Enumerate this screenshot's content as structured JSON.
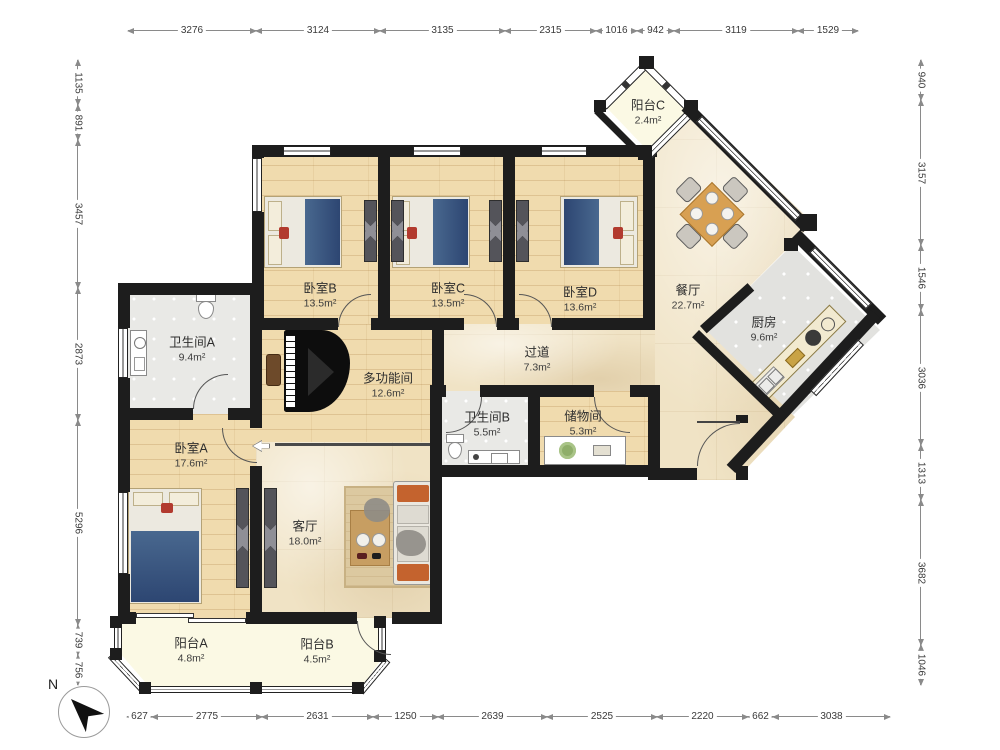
{
  "title": "apartment-floor-plan",
  "compass": {
    "north_label": "N"
  },
  "rooms": {
    "bedroomB": {
      "name": "卧室B",
      "area": "13.5m²"
    },
    "bedroomC": {
      "name": "卧室C",
      "area": "13.5m²"
    },
    "bedroomD": {
      "name": "卧室D",
      "area": "13.6m²"
    },
    "balconyC": {
      "name": "阳台C",
      "area": "2.4m²"
    },
    "dining": {
      "name": "餐厅",
      "area": "22.7m²"
    },
    "kitchen": {
      "name": "厨房",
      "area": "9.6m²"
    },
    "bathroomA": {
      "name": "卫生间A",
      "area": "9.4m²"
    },
    "multiroom": {
      "name": "多功能间",
      "area": "12.6m²"
    },
    "hallway": {
      "name": "过道",
      "area": "7.3m²"
    },
    "bathroomB": {
      "name": "卫生间B",
      "area": "5.5m²"
    },
    "storage": {
      "name": "储物间",
      "area": "5.3m²"
    },
    "bedroomA": {
      "name": "卧室A",
      "area": "17.6m²"
    },
    "living": {
      "name": "客厅",
      "area": "18.0m²"
    },
    "balconyA": {
      "name": "阳台A",
      "area": "4.8m²"
    },
    "balconyB": {
      "name": "阳台B",
      "area": "4.5m²"
    }
  },
  "dimensions": {
    "top": [
      "3276",
      "3124",
      "3135",
      "2315",
      "1016",
      "942",
      "3119",
      "1529"
    ],
    "bottom": [
      "627",
      "2775",
      "2631",
      "1250",
      "2639",
      "2525",
      "2220",
      "662",
      "3038"
    ],
    "left": [
      "1135",
      "891",
      "3457",
      "2873",
      "5296",
      "739",
      "756"
    ],
    "right": [
      "940",
      "3157",
      "1546",
      "3036",
      "1313",
      "3682",
      "1046"
    ]
  },
  "colors": {
    "wall": "#1d1d1d",
    "wood_floor": "#f0dbae",
    "marble_floor": "#f0e3c5",
    "tile_floor": "#e9e9e6",
    "balcony_floor": "#fbf9e4",
    "bed_blanket": "#2d4672",
    "sofa_cushion": "#c4632e",
    "dining_table": "#d8a052"
  }
}
